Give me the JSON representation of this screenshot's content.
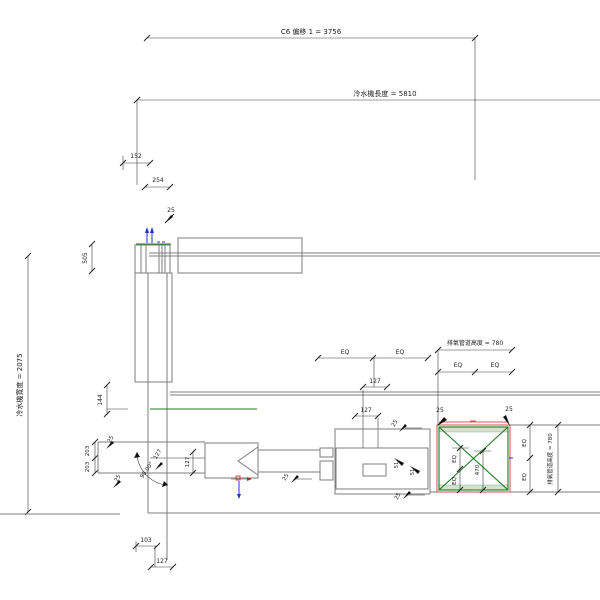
{
  "drawing": {
    "type": "cad-plan-view",
    "colors": {
      "background": "#ffffff",
      "geometry_gray": "#7d7d7d",
      "dimension_dark": "#3a3a3a",
      "accent_green": "#1e7a1e",
      "accent_red": "#cc2222",
      "accent_blue": "#2233cc",
      "band_fill": "#cfe3cf"
    }
  },
  "labels": {
    "c6_offset": "C6 偏移 1 = 3756",
    "chiller_length": "冷水機長度 = 5810",
    "chiller_width": "冷水機寬度 = 2075",
    "exhaust_duct_height_top": "排氣管道高度 = 780",
    "exhaust_duct_height_right": "排氣管道高度 = 780",
    "angle_90": "90.00°"
  },
  "dims": {
    "d152": "152",
    "d254": "254",
    "d25_top": "25",
    "d505": "505",
    "d144": "144",
    "d203_top": "203",
    "d203_bottom": "203",
    "d25_elbow_top": "25",
    "d25_elbow_bottom": "25",
    "d127_elbow_a": "127",
    "d127_elbow_b": "127",
    "d25_pipe": "25",
    "eq": "EQ",
    "d127_mid": "127",
    "d127_lower": "127",
    "d25_box_left": "25",
    "d25_box_right": "25",
    "d470": "470",
    "d51_a": "51",
    "d51_b": "51",
    "d25_unit_top": "25",
    "d25_unit_bottom": "25",
    "d103": "103",
    "d127_bottom": "127"
  }
}
